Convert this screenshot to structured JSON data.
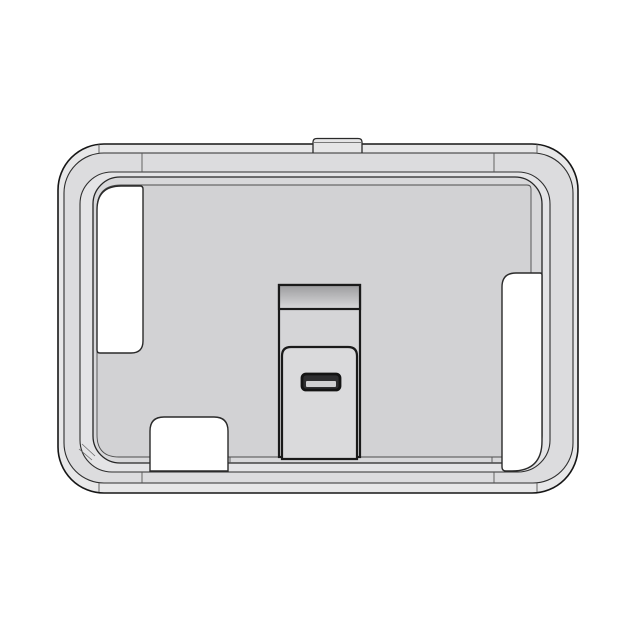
{
  "scene": {
    "type": "cad-render",
    "object": "rounded-rectangular-case-enclosure",
    "view": "front-orthographic"
  },
  "colors": {
    "background": "#ffffff",
    "outline_dark": "#161616",
    "frame_outer_face": "#e7e7e8",
    "frame_chamfer": "#dcdcde",
    "frame_lip_top": "#e4e4e6",
    "lip_wall": "#d8d8da",
    "floor": "#d2d2d4",
    "cutout": "#ffffff",
    "stand_body": "#d5d5d7",
    "stand_card": "#dadadc",
    "stand_top_dark": "#9c9c9e",
    "stand_top_light": "#d9d9db",
    "slot_fill": "#2e2e30",
    "slot_band": "#cfcfd1",
    "tab": "#e6e6e7"
  },
  "parts": {
    "frame": "outer rounded frame",
    "bezel_lip": "inner stepped lip",
    "floor": "recessed back panel",
    "left_cutout": "left side opening",
    "bottom_left_cutout": "bottom-left opening",
    "right_cutout": "right side opening",
    "stand": "center stand column",
    "slot": "connector slot",
    "top_tab": "top latch tab"
  }
}
